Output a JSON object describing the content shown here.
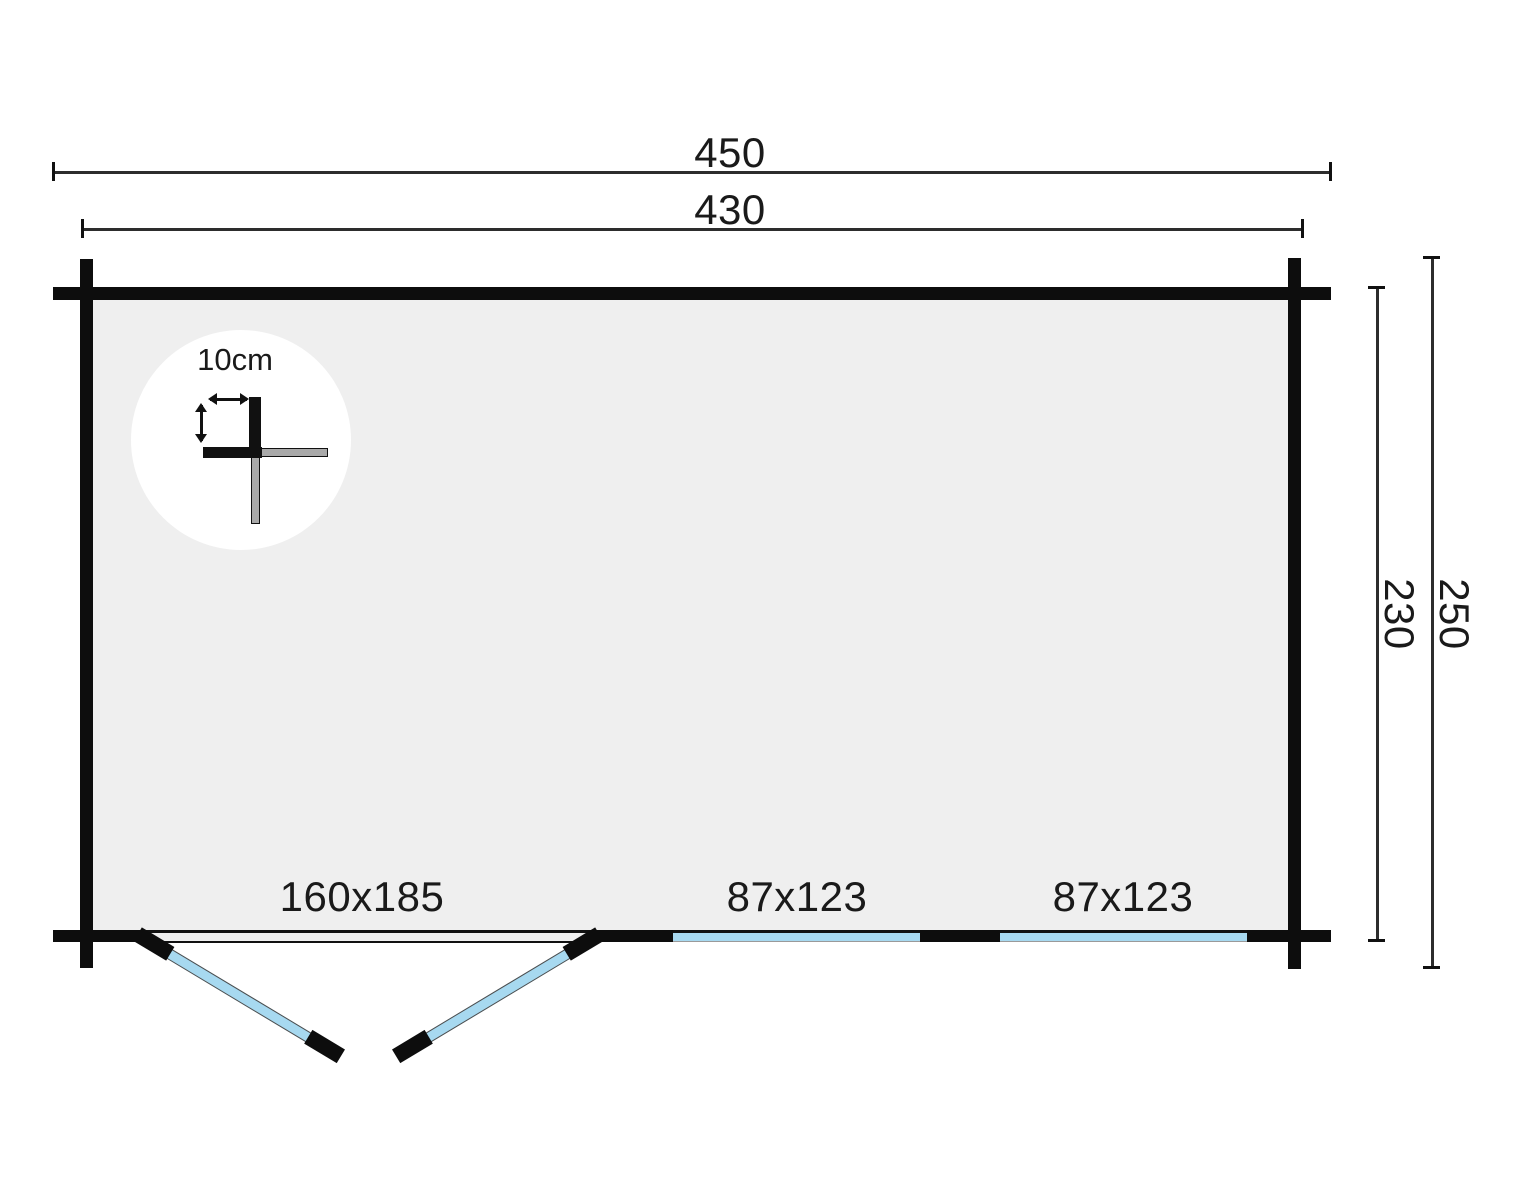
{
  "dimensions": {
    "overall_width": "450",
    "inner_width": "430",
    "overall_depth": "250",
    "inner_depth": "230"
  },
  "detail": {
    "wall_thickness": "10cm"
  },
  "openings": {
    "door_label": "160x185",
    "windows": [
      {
        "label": "87x123"
      },
      {
        "label": "87x123"
      }
    ]
  },
  "colors": {
    "wall": "#0d0d0d",
    "interior": "#efefef",
    "glass": "#a7d9f0",
    "log_end_gray": "#a9a9a9",
    "dimension_line": "#2d2d2d",
    "background": "#ffffff"
  }
}
